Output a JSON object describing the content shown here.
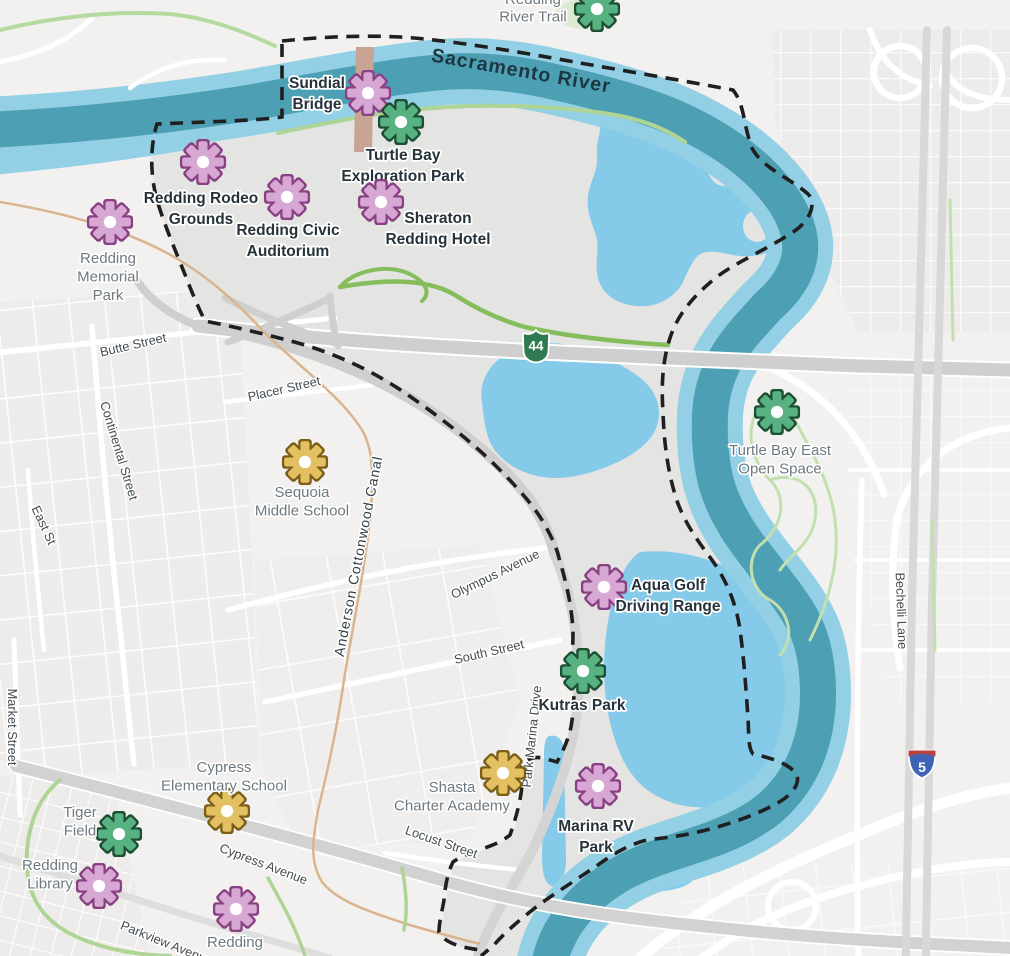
{
  "colors": {
    "bg": "#f2f1ef",
    "block_fill": "#edecea",
    "inside_gray": "#e4e4e2",
    "river_main": "#4d9fb4",
    "river_edge": "#93d0e5",
    "pond": "#85cbe9",
    "boundary": "#1f1f1f",
    "road_gray": "#cfcfcf",
    "trail_green": "#a9d593",
    "trail_bright": "#85bd5d",
    "canal_tan": "#d9b48e",
    "bridge_tan": "#c8a494",
    "label_dark": "#27333a",
    "label_gray": "#6f7980",
    "street_label": "#434c52",
    "poi_pink_fill": "#d8a8d4",
    "poi_pink_stroke": "#8a4183",
    "poi_green_fill": "#57b181",
    "poi_green_stroke": "#1c4f33",
    "poi_yellow_fill": "#e3c162",
    "poi_yellow_stroke": "#7c5f17",
    "shield_ca_green": "#2e7a50",
    "shield_i5_blue": "#3e64b5",
    "shield_i5_red": "#b6433c"
  },
  "waterway_labels": {
    "river": {
      "text": "Sacramento River"
    },
    "canal": {
      "text": "Anderson Cottonwood Canal"
    }
  },
  "highway_shields": [
    {
      "type": "ca-state",
      "number": "44",
      "x": 536,
      "y": 345
    },
    {
      "type": "interstate",
      "number": "5",
      "x": 922,
      "y": 764
    }
  ],
  "pois": [
    {
      "id": "redding-river-trail",
      "lines": [
        "Redding",
        "River Trail"
      ],
      "category": "green",
      "emphasis": "out",
      "icon": {
        "x": 597,
        "y": 9
      },
      "label": {
        "x": 533,
        "y": 4
      },
      "lh": 17.5
    },
    {
      "id": "sundial-bridge",
      "lines": [
        "Sundial",
        "Bridge"
      ],
      "category": "pink",
      "emphasis": "in",
      "icon": {
        "x": 368,
        "y": 93
      },
      "label": {
        "x": 317,
        "y": 88
      }
    },
    {
      "id": "turtle-bay-exploration-park",
      "lines": [
        "Turtle Bay",
        "Exploration Park"
      ],
      "category": "green",
      "emphasis": "in",
      "icon": {
        "x": 401,
        "y": 122
      },
      "label": {
        "x": 403,
        "y": 160
      }
    },
    {
      "id": "redding-rodeo-grounds",
      "lines": [
        "Redding Rodeo",
        "Grounds"
      ],
      "category": "pink",
      "emphasis": "in",
      "icon": {
        "x": 203,
        "y": 162
      },
      "label": {
        "x": 201,
        "y": 203
      }
    },
    {
      "id": "redding-civic-auditorium",
      "lines": [
        "Redding Civic",
        "Auditorium"
      ],
      "category": "pink",
      "emphasis": "in",
      "icon": {
        "x": 287,
        "y": 197
      },
      "label": {
        "x": 288,
        "y": 235
      }
    },
    {
      "id": "sheraton-redding-hotel",
      "lines": [
        "Sheraton",
        "Redding Hotel"
      ],
      "category": "pink",
      "emphasis": "in",
      "icon": {
        "x": 381,
        "y": 202
      },
      "label": {
        "x": 438,
        "y": 223
      }
    },
    {
      "id": "redding-memorial-park",
      "lines": [
        "Redding",
        "Memorial",
        "Park"
      ],
      "category": "pink",
      "emphasis": "out",
      "icon": {
        "x": 110,
        "y": 222
      },
      "label": {
        "x": 108,
        "y": 263
      }
    },
    {
      "id": "sequoia-middle-school",
      "lines": [
        "Sequoia",
        "Middle School"
      ],
      "category": "yellow",
      "emphasis": "out",
      "icon": {
        "x": 305,
        "y": 462
      },
      "label": {
        "x": 302,
        "y": 497
      }
    },
    {
      "id": "turtle-bay-east-open-space",
      "lines": [
        "Turtle Bay East",
        "Open Space"
      ],
      "category": "green",
      "emphasis": "out",
      "icon": {
        "x": 777,
        "y": 412
      },
      "label": {
        "x": 780,
        "y": 455
      }
    },
    {
      "id": "aqua-golf-driving-range",
      "lines": [
        "Aqua Golf",
        "Driving Range"
      ],
      "category": "pink",
      "emphasis": "in",
      "icon": {
        "x": 604,
        "y": 587
      },
      "label": {
        "x": 668,
        "y": 590
      }
    },
    {
      "id": "kutras-park",
      "lines": [
        "Kutras Park"
      ],
      "category": "green",
      "emphasis": "in",
      "icon": {
        "x": 583,
        "y": 671
      },
      "label": {
        "x": 582,
        "y": 710
      }
    },
    {
      "id": "cypress-elementary-school",
      "lines": [
        "Cypress",
        "Elementary School"
      ],
      "category": "yellow",
      "emphasis": "out",
      "icon": {
        "x": 227,
        "y": 811
      },
      "label": {
        "x": 224,
        "y": 772
      }
    },
    {
      "id": "tiger-field",
      "lines": [
        "Tiger",
        "Field"
      ],
      "category": "green",
      "emphasis": "out",
      "icon": {
        "x": 119,
        "y": 834
      },
      "label": {
        "x": 80,
        "y": 817
      }
    },
    {
      "id": "shasta-charter-academy",
      "lines": [
        "Shasta",
        "Charter Academy"
      ],
      "category": "yellow",
      "emphasis": "out",
      "icon": {
        "x": 503,
        "y": 773
      },
      "label": {
        "x": 452,
        "y": 792
      }
    },
    {
      "id": "marina-rv-park",
      "lines": [
        "Marina RV",
        "Park"
      ],
      "category": "pink",
      "emphasis": "in",
      "icon": {
        "x": 598,
        "y": 786
      },
      "label": {
        "x": 596,
        "y": 831
      }
    },
    {
      "id": "redding-library",
      "lines": [
        "Redding",
        "Library"
      ],
      "category": "pink",
      "emphasis": "out",
      "icon": {
        "x": 99,
        "y": 886
      },
      "label": {
        "x": 50,
        "y": 870
      }
    },
    {
      "id": "redding-south",
      "lines": [
        "Redding"
      ],
      "category": "pink",
      "emphasis": "out",
      "icon": {
        "x": 236,
        "y": 909
      },
      "label": {
        "x": 235,
        "y": 947
      }
    }
  ],
  "streets": [
    {
      "name": "Butte Street",
      "x": 134,
      "y": 349,
      "rotate": -13
    },
    {
      "name": "Placer Street",
      "x": 285,
      "y": 393,
      "rotate": -13
    },
    {
      "name": "Continental Street",
      "x": 115,
      "y": 452,
      "rotate": 73
    },
    {
      "name": "East St",
      "x": 40,
      "y": 527,
      "rotate": 65
    },
    {
      "name": "Market Street",
      "x": 8,
      "y": 727,
      "rotate": 90
    },
    {
      "name": "Olympus Avenue",
      "x": 497,
      "y": 578,
      "rotate": -26
    },
    {
      "name": "South Street",
      "x": 490,
      "y": 656,
      "rotate": -13
    },
    {
      "name": "Locust Street",
      "x": 440,
      "y": 846,
      "rotate": 19
    },
    {
      "name": "Park Marina Drive",
      "x": 536,
      "y": 737,
      "rotate": -84
    },
    {
      "name": "Cypress Avenue",
      "x": 262,
      "y": 868,
      "rotate": 21
    },
    {
      "name": "Parkview Avenue",
      "x": 165,
      "y": 947,
      "rotate": 22
    },
    {
      "name": "Bechelli Lane",
      "x": 897,
      "y": 611,
      "rotate": 88
    }
  ]
}
